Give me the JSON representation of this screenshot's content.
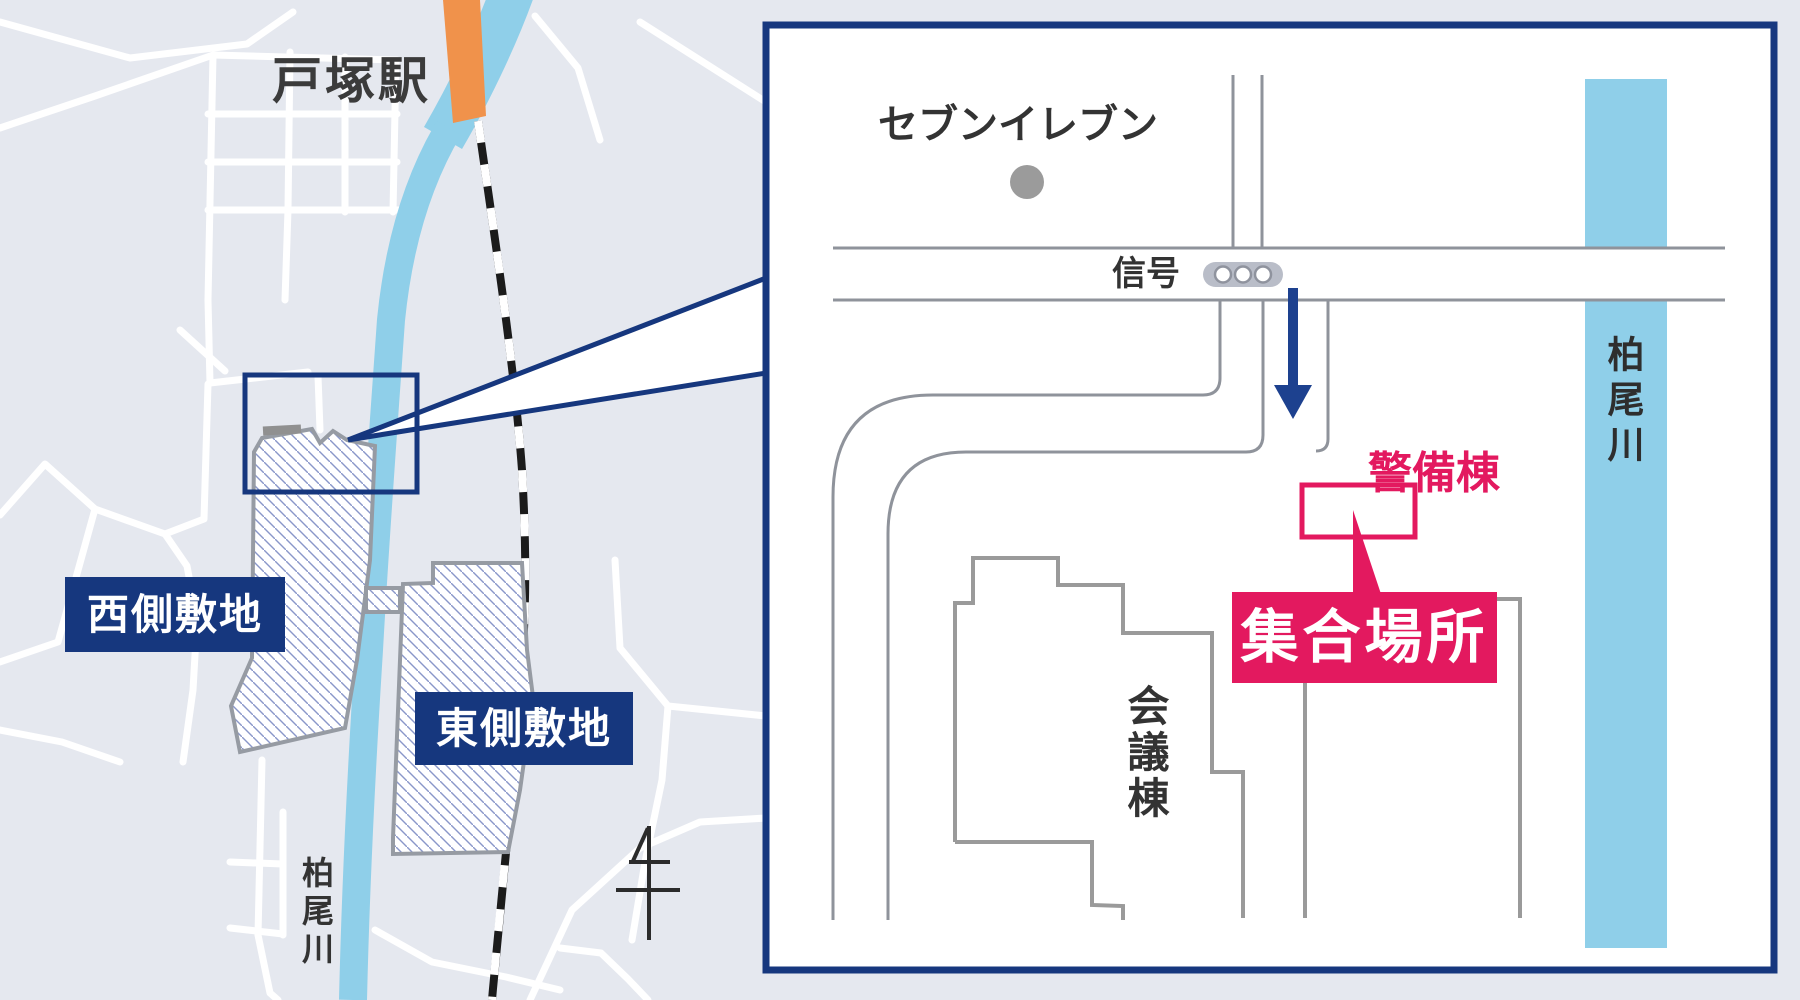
{
  "colors": {
    "navy": "#16377e",
    "crimson": "#e3195f",
    "river_blue": "#8fcfe9",
    "station_orange": "#f0924b",
    "map_background": "#e5e8ef",
    "road_edge_gray": "#8f939b",
    "building_gray": "#9a9a9a",
    "text_dark": "#333333",
    "signal_gray": "#b9bdc8",
    "poi_dot_gray": "#9b9b9b"
  },
  "left_map": {
    "station_label": "戸塚駅",
    "west_site_label": "西側敷地",
    "east_site_label": "東側敷地",
    "river_label": "柏尾川"
  },
  "inset_map": {
    "seven_eleven_label": "セブンイレブン",
    "signal_label": "信号",
    "security_building_label": "警備棟",
    "meeting_place_label": "集合場所",
    "conference_building_label": "会議棟",
    "river_label": "柏尾川"
  }
}
